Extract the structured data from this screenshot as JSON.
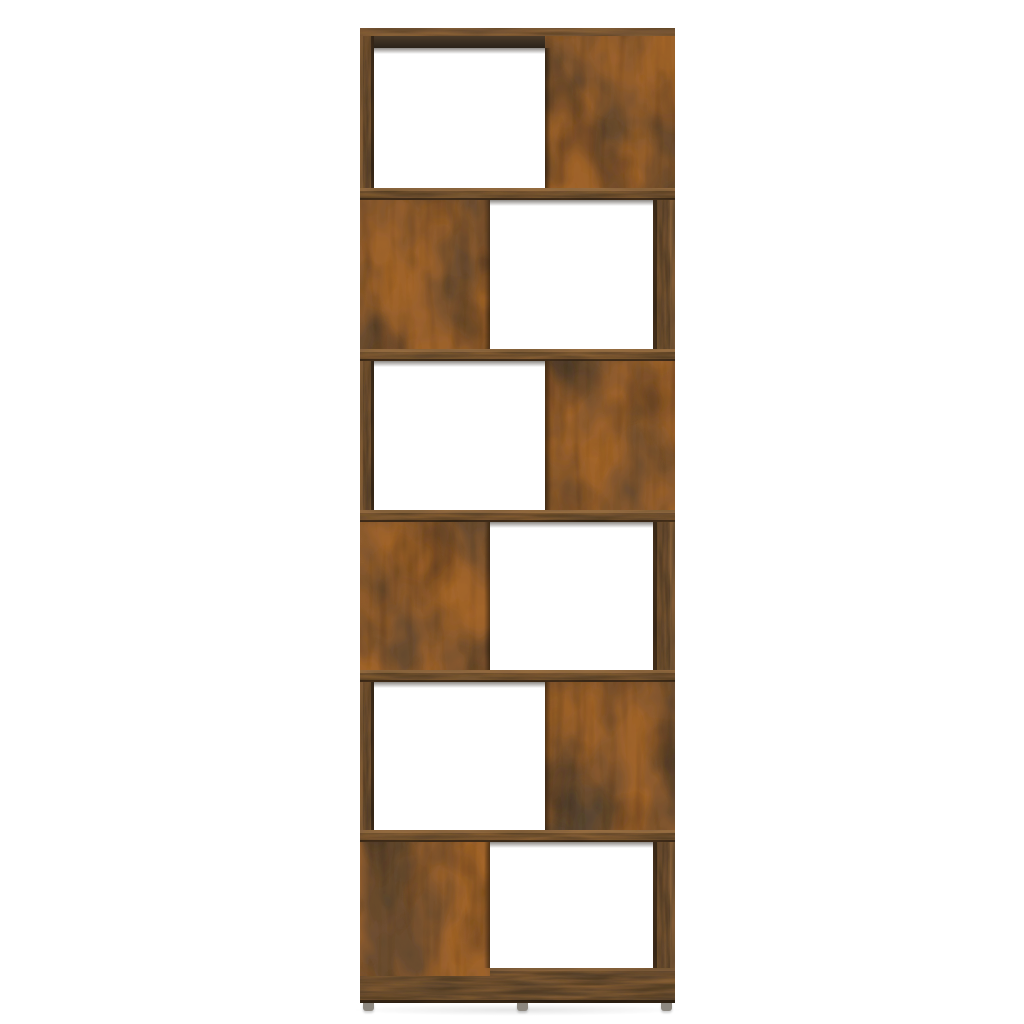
{
  "scene": {
    "subject": "Six-tier zig-zag book cabinet room divider shelf, smoked oak wood finish, front view on plain white background",
    "tier_count": 6,
    "open_compartment_count": 6,
    "feet_visible": 3,
    "background_color": "#ffffff"
  },
  "shelf": {
    "tiers": [
      {
        "id": "tier-1",
        "open_side": "left",
        "panel_side": "right",
        "seed": 5
      },
      {
        "id": "tier-2",
        "open_side": "right",
        "panel_side": "left",
        "seed": 11
      },
      {
        "id": "tier-3",
        "open_side": "left",
        "panel_side": "right",
        "seed": 23
      },
      {
        "id": "tier-4",
        "open_side": "right",
        "panel_side": "left",
        "seed": 37
      },
      {
        "id": "tier-5",
        "open_side": "left",
        "panel_side": "right",
        "seed": 53
      },
      {
        "id": "tier-6",
        "open_side": "right",
        "panel_side": "left",
        "seed": 71
      }
    ],
    "board_seeds": [
      3,
      9,
      17
    ],
    "strip_seeds": [
      4,
      13
    ]
  },
  "palette": {
    "background": "#ffffff",
    "wood_base": "#4e4232",
    "wood_rust": "#ad6a2c",
    "wood_dark": "#2e2922",
    "wood_streak": "#201910",
    "board_base": "#6b4f33",
    "board_rust": "#9a6a38",
    "board_dark": "#33271a",
    "strip_base": "#57432d",
    "cap_base": "#7d5c3b",
    "bottom_base": "#5f4830",
    "foot_color": "#8d8880"
  }
}
